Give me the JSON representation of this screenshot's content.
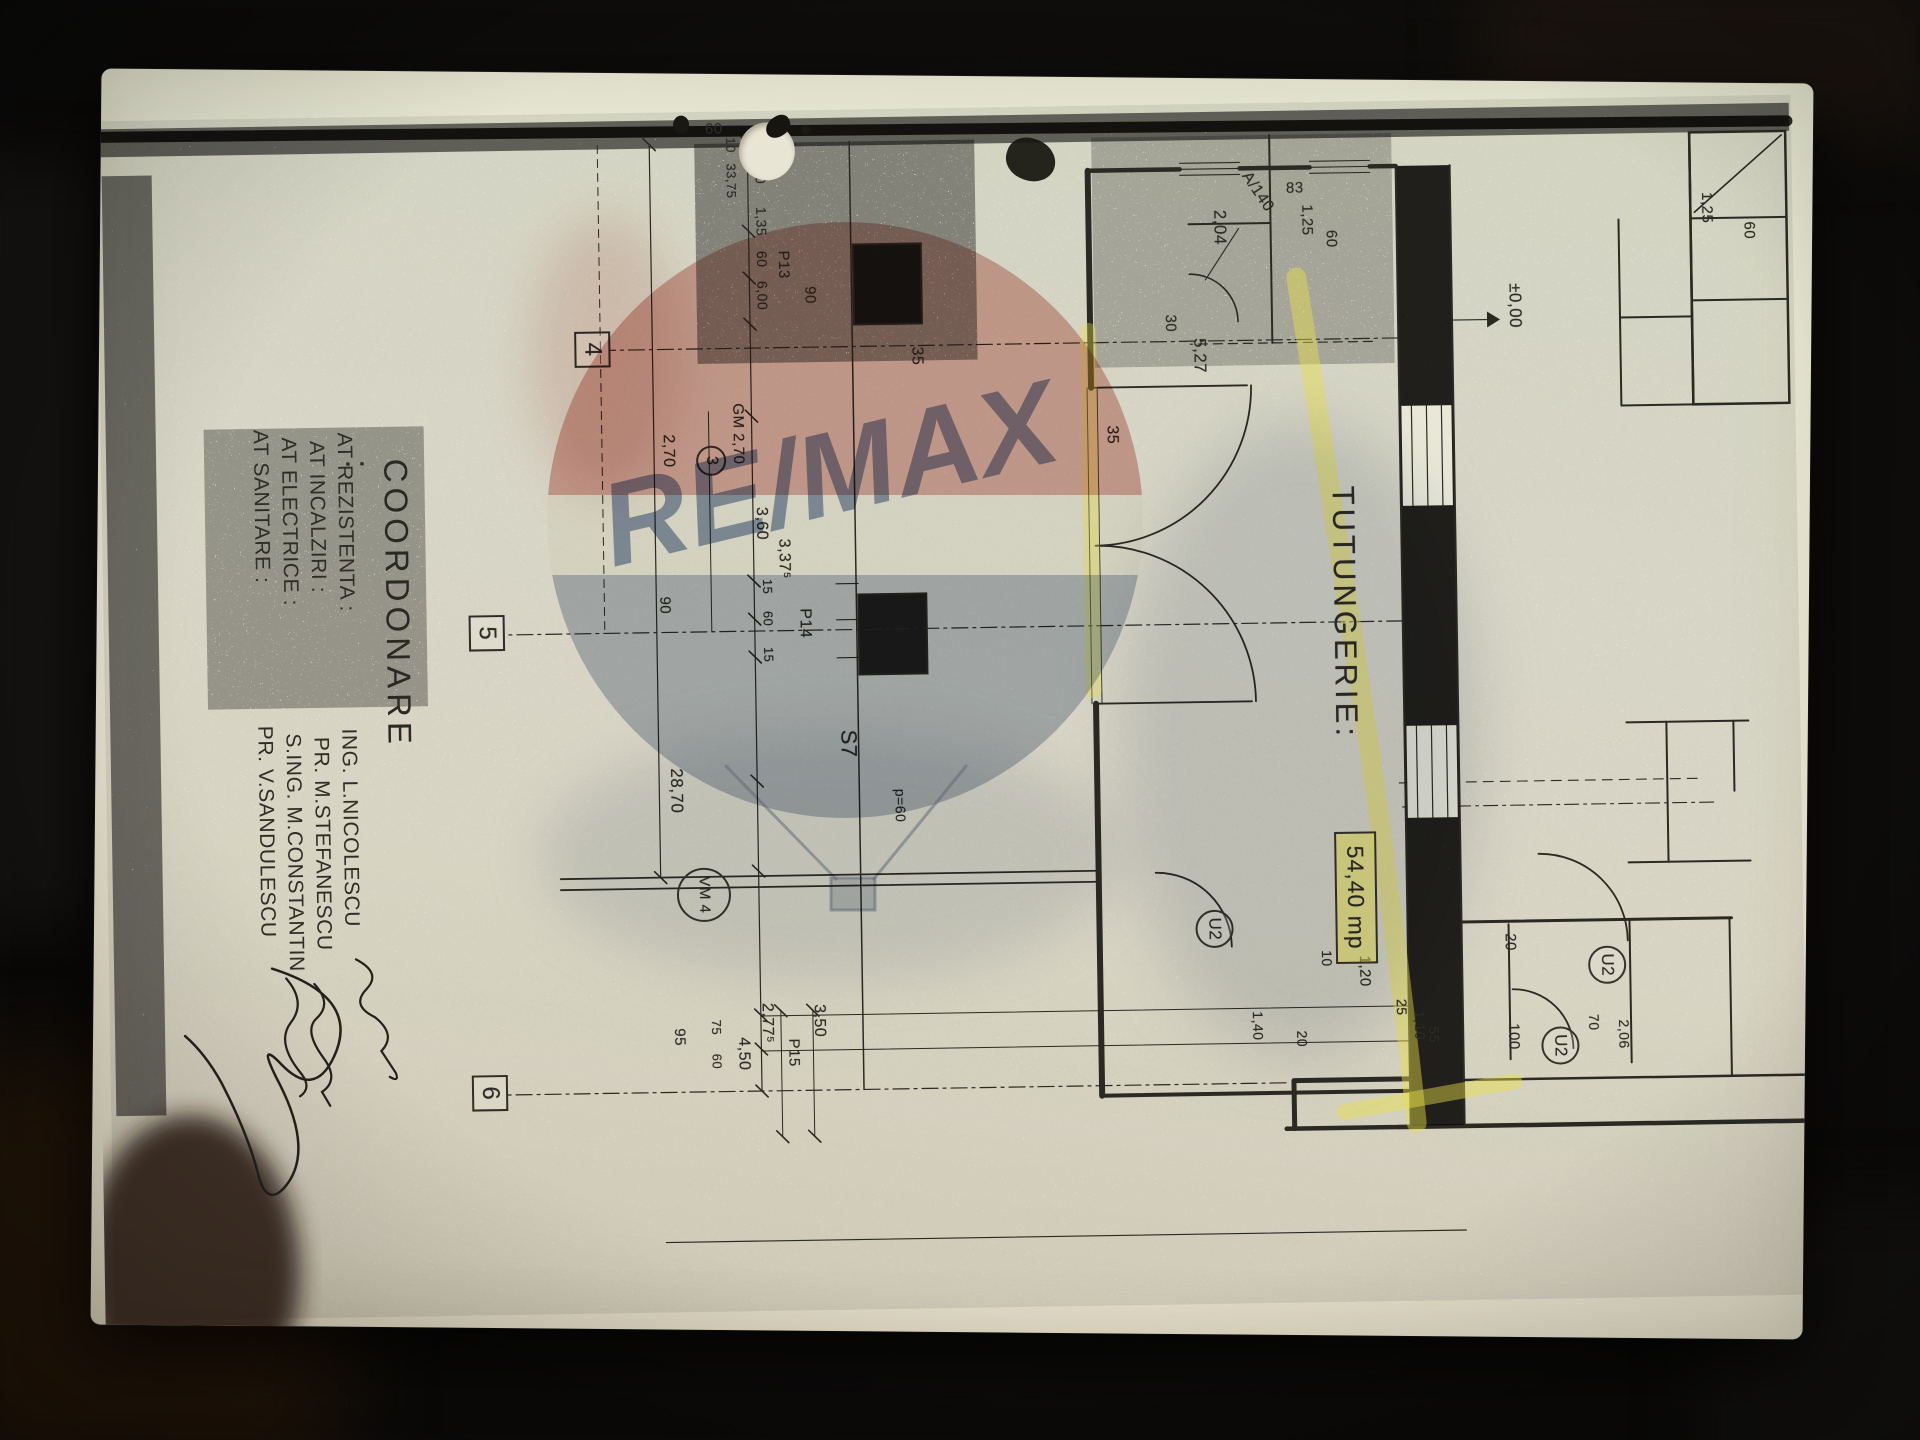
{
  "scene": {
    "description": "Photo of a photocopied architectural floor plan sheet, rotated 90 degrees, lying on a dark surface"
  },
  "watermark": {
    "brand": "RE/MAX",
    "colors": {
      "balloon_red": "#c66a5f",
      "balloon_blue": "#8093a8",
      "text_blue": "#46608f"
    }
  },
  "plan": {
    "highlight_color": "#e8e04a",
    "coordination": {
      "heading": "COORDONARE :",
      "entries": [
        {
          "discipline": "AT REZISTENTA :",
          "engineer": "ING. L.NICOLESCU",
          "x": 345,
          "y": 1448
        },
        {
          "discipline": "AT INCALZIRI :",
          "engineer": "PR. M.STEFANESCU",
          "x": 353,
          "y": 1476
        },
        {
          "discipline": "AT ELECTRICE :",
          "engineer": "S.ING. M.CONSTANTIN",
          "x": 349,
          "y": 1504
        },
        {
          "discipline": "AT SANITARE :",
          "engineer": "PR. V.SANDULESCU",
          "x": 341,
          "y": 1532
        }
      ]
    },
    "grid_markers": [
      "4",
      "5",
      "6"
    ],
    "labels": [
      {
        "t": "60",
        "x": 156,
        "y": 44,
        "s": 15
      },
      {
        "t": "1,25",
        "x": 126,
        "y": 86,
        "s": 15
      },
      {
        "t": "83",
        "x": 108,
        "y": 514,
        "s": 15,
        "r": -90
      },
      {
        "t": "1,25",
        "x": 132,
        "y": 486,
        "s": 15
      },
      {
        "t": "60",
        "x": 158,
        "y": 462,
        "s": 15
      },
      {
        "t": "A/140",
        "x": 96,
        "y": 548,
        "s": 16,
        "r": -33,
        "n": "door-tag"
      },
      {
        "t": "2,04",
        "x": 136,
        "y": 572,
        "s": 17
      },
      {
        "t": "5,27",
        "x": 264,
        "y": 594,
        "s": 17
      },
      {
        "t": "30",
        "x": 240,
        "y": 624,
        "s": 15
      },
      {
        "t": "±0,00",
        "x": 214,
        "y": 278,
        "s": 17,
        "n": "level-marker"
      },
      {
        "t": "2,06",
        "x": 952,
        "y": 182,
        "s": 14
      },
      {
        "t": "70",
        "x": 946,
        "y": 212,
        "s": 14
      },
      {
        "t": "U2",
        "k": "circ",
        "x": 878,
        "y": 186,
        "n": "door-label"
      },
      {
        "t": "U2",
        "k": "circ",
        "x": 958,
        "y": 234,
        "n": "door-label"
      },
      {
        "t": "U2",
        "k": "circ",
        "x": 836,
        "y": 578,
        "n": "door-label"
      },
      {
        "t": "20",
        "x": 864,
        "y": 294,
        "s": 15
      },
      {
        "t": "100",
        "x": 954,
        "y": 292,
        "s": 15
      },
      {
        "t": "25",
        "x": 928,
        "y": 404,
        "s": 14
      },
      {
        "t": "1,10",
        "x": 940,
        "y": 386,
        "s": 14
      },
      {
        "t": "55",
        "x": 956,
        "y": 372,
        "s": 14
      },
      {
        "t": "1,20",
        "x": 884,
        "y": 440,
        "s": 15
      },
      {
        "t": "10",
        "x": 878,
        "y": 478,
        "s": 14
      },
      {
        "t": "20",
        "x": 958,
        "y": 504,
        "s": 14
      },
      {
        "t": "1,40",
        "x": 938,
        "y": 548,
        "s": 14
      },
      {
        "t": "35",
        "x": 350,
        "y": 684,
        "s": 16
      },
      {
        "t": "TUTUNGERIE:",
        "x": 414,
        "y": 446,
        "s": 31,
        "k": "room",
        "n": "room-name"
      },
      {
        "t": "54,40 mp",
        "x": 760,
        "y": 434,
        "k": "area",
        "n": "room-area"
      },
      {
        "t": "5",
        "x": 74,
        "y": 1008,
        "s": 14
      },
      {
        "t": "90",
        "x": 206,
        "y": 984,
        "s": 15
      },
      {
        "t": "P13",
        "x": 170,
        "y": 1010,
        "s": 15
      },
      {
        "t": "35",
        "x": 268,
        "y": 878,
        "s": 16
      },
      {
        "t": "GM 2,70",
        "x": 322,
        "y": 1058,
        "s": 15
      },
      {
        "t": "3",
        "k": "circs",
        "x": 364,
        "y": 1078,
        "n": "door-label"
      },
      {
        "t": "2,70",
        "x": 352,
        "y": 1128,
        "s": 16
      },
      {
        "t": "3,60",
        "x": 426,
        "y": 1036,
        "s": 16
      },
      {
        "t": "3,37⁵",
        "x": 458,
        "y": 1014,
        "s": 16
      },
      {
        "t": "15",
        "x": 498,
        "y": 1032,
        "s": 13
      },
      {
        "t": "60",
        "x": 530,
        "y": 1032,
        "s": 13
      },
      {
        "t": "15",
        "x": 566,
        "y": 1032,
        "s": 13
      },
      {
        "t": "P14",
        "x": 528,
        "y": 994,
        "s": 16
      },
      {
        "t": "90",
        "x": 514,
        "y": 1134,
        "s": 15
      },
      {
        "t": "S7",
        "x": 650,
        "y": 948,
        "s": 22,
        "n": "section-label"
      },
      {
        "t": "p=60",
        "x": 710,
        "y": 902,
        "s": 14
      },
      {
        "t": "28,70",
        "x": 686,
        "y": 1124,
        "s": 17
      },
      {
        "t": "VM 4",
        "k": "vm",
        "x": 786,
        "y": 1080,
        "n": "door-label"
      },
      {
        "t": "3,50",
        "x": 924,
        "y": 986,
        "s": 16
      },
      {
        "t": "P15",
        "x": 958,
        "y": 1012,
        "s": 15
      },
      {
        "t": "2,77⁵",
        "x": 922,
        "y": 1038,
        "s": 16
      },
      {
        "t": "4,50",
        "x": 956,
        "y": 1062,
        "s": 16
      },
      {
        "t": "75",
        "x": 938,
        "y": 1090,
        "s": 13
      },
      {
        "t": "60",
        "x": 972,
        "y": 1090,
        "s": 13
      },
      {
        "t": "95",
        "x": 946,
        "y": 1126,
        "s": 15
      },
      {
        "t": "2,40",
        "x": 74,
        "y": 1032,
        "s": 14
      },
      {
        "t": "1,35",
        "x": 126,
        "y": 1032,
        "s": 14
      },
      {
        "t": "60",
        "x": 170,
        "y": 1032,
        "s": 14
      },
      {
        "t": "6,00",
        "x": 200,
        "y": 1032,
        "s": 14
      },
      {
        "t": "10",
        "x": 56,
        "y": 1062,
        "s": 13
      },
      {
        "t": "33,75",
        "x": 82,
        "y": 1062,
        "s": 13
      },
      {
        "t": "60",
        "x": 40,
        "y": 1094,
        "s": 15,
        "r": -90
      },
      {
        "t": "4",
        "k": "box",
        "x": 248,
        "y": 1192,
        "n": "grid-marker"
      },
      {
        "t": "5",
        "k": "box",
        "x": 530,
        "y": 1302,
        "n": "grid-marker"
      },
      {
        "t": "6",
        "k": "box",
        "x": 990,
        "y": 1306,
        "n": "grid-marker"
      }
    ]
  }
}
